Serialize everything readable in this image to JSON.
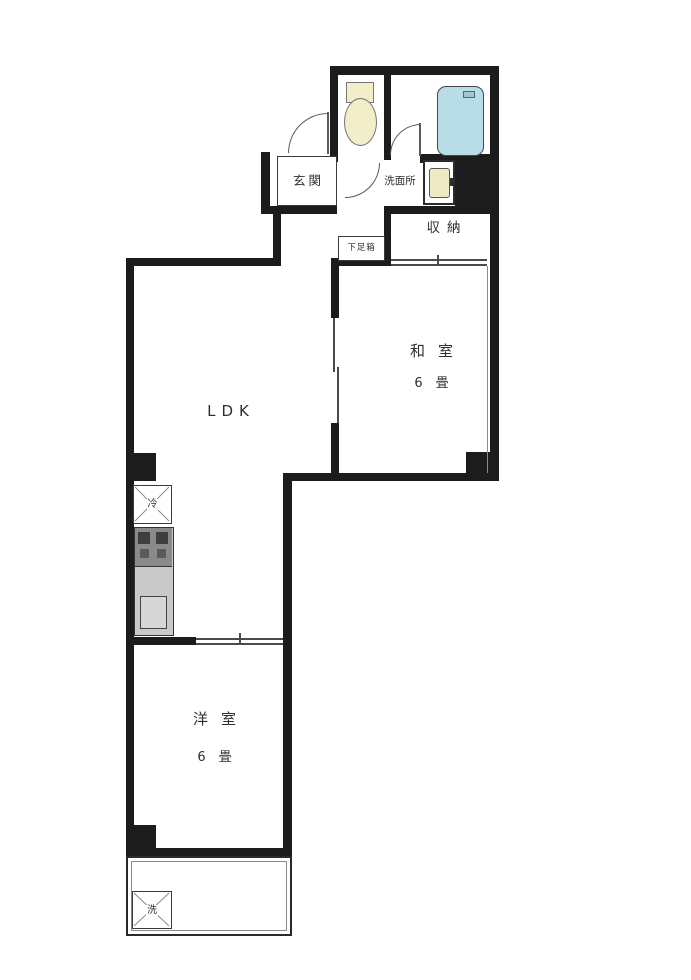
{
  "rooms": {
    "ldk": {
      "label": "LDK"
    },
    "washitsu": {
      "label": "和室",
      "size": "6畳"
    },
    "youshitsu": {
      "label": "洋室",
      "size": "6畳"
    },
    "genkan": {
      "label": "玄関"
    },
    "senmenjo": {
      "label": "洗面所"
    },
    "shuunou": {
      "label": "収納"
    },
    "shoe_cabinet": {
      "label": "下足箱"
    },
    "refrigerator": {
      "label": "冷"
    },
    "washer": {
      "label": "洗"
    }
  },
  "colors": {
    "wall": "#1c1c1c",
    "bathtub": "#b9dde6",
    "toilet_fixture": "#f1eec9",
    "stove": "#8a8a8a",
    "counter": "#c9c9c9",
    "background": "#ffffff"
  }
}
